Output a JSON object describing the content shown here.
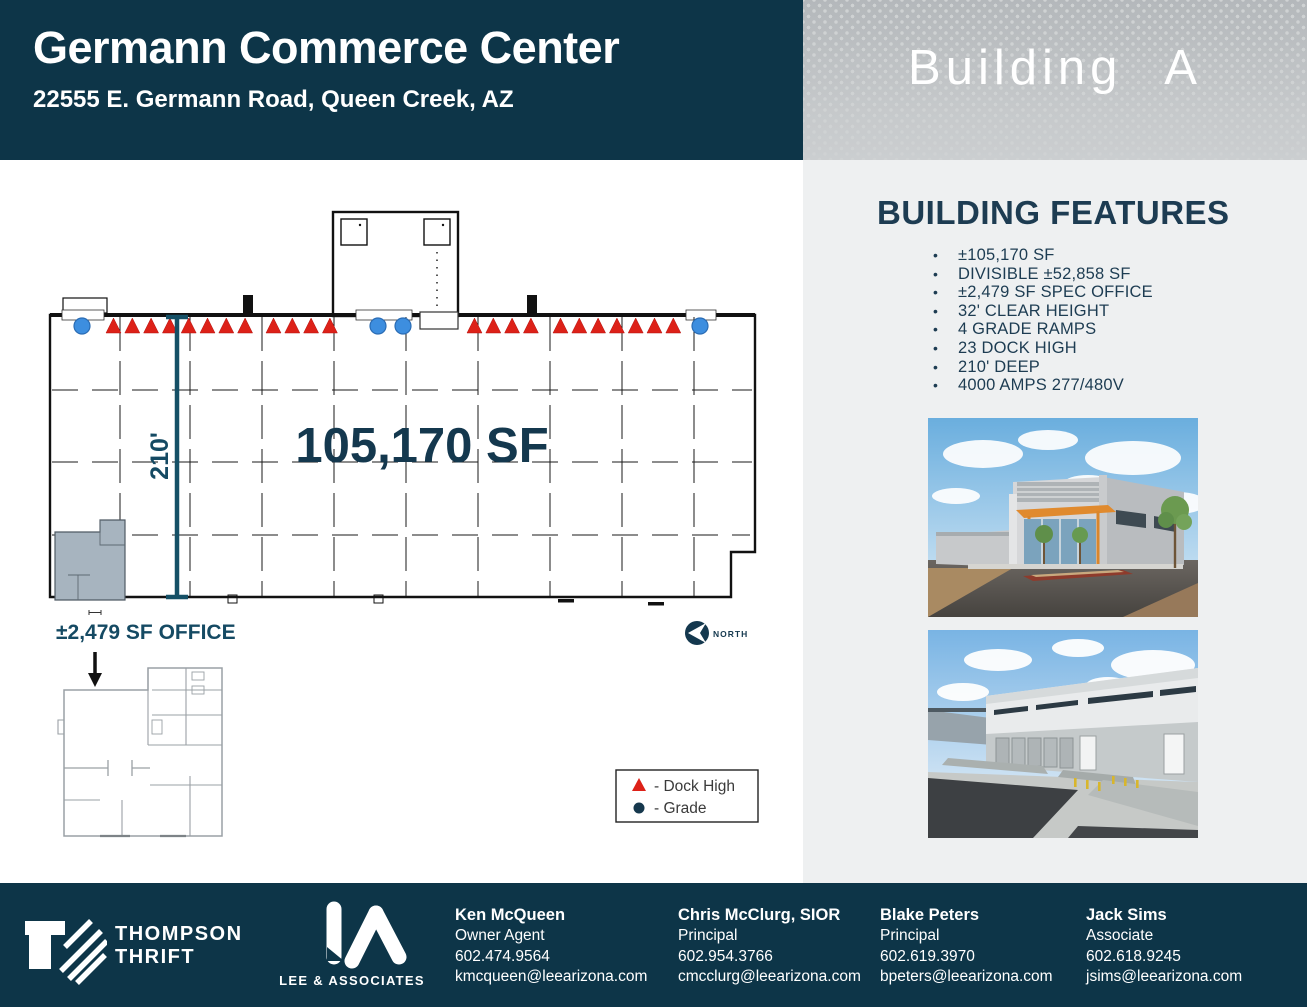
{
  "header": {
    "title": "Germann Commerce Center",
    "address": "22555 E. Germann Road, Queen Creek, AZ",
    "building_label": "Building A"
  },
  "features": {
    "title": "BUILDING FEATURES",
    "items": [
      "±105,170 SF",
      "DIVISIBLE ±52,858 SF",
      "±2,479 SF SPEC OFFICE",
      "32' CLEAR HEIGHT",
      "4 GRADE RAMPS",
      "23 DOCK HIGH",
      "210' DEEP",
      "4000 AMPS 277/480V"
    ]
  },
  "floor_plan": {
    "area_label": "105,170 SF",
    "depth_label": "210'",
    "office_label": "±2,479 SF OFFICE",
    "north_label": "NORTH",
    "legend": {
      "dock_label": "- Dock High",
      "grade_label": "- Grade"
    },
    "dock_high_count": 23,
    "grade_count": 4,
    "markers": [
      {
        "type": "grade",
        "cx": 82
      },
      {
        "type": "dock",
        "start": 106,
        "count": 8,
        "step": 18.8
      },
      {
        "type": "dock",
        "start": 266,
        "count": 4,
        "step": 18.8
      },
      {
        "type": "grade",
        "cx": 378
      },
      {
        "type": "grade",
        "cx": 403
      },
      {
        "type": "dock",
        "start": 467,
        "count": 4,
        "step": 18.8
      },
      {
        "type": "dock",
        "start": 553,
        "count": 7,
        "step": 18.8
      },
      {
        "type": "grade",
        "cx": 700
      }
    ]
  },
  "footer": {
    "brand1_line1": "THOMPSON",
    "brand1_line2": "THRIFT",
    "brand2": "LEE & ASSOCIATES",
    "contacts": [
      {
        "name": "Ken McQueen",
        "title": "Owner Agent",
        "phone": "602.474.9564",
        "email": "kmcqueen@leearizona.com"
      },
      {
        "name": "Chris McClurg, SIOR",
        "title": "Principal",
        "phone": "602.954.3766",
        "email": "cmcclurg@leearizona.com"
      },
      {
        "name": "Blake Peters",
        "title": "Principal",
        "phone": "602.619.3970",
        "email": "bpeters@leearizona.com"
      },
      {
        "name": "Jack Sims",
        "title": "Associate",
        "phone": "602.618.9245",
        "email": "jsims@leearizona.com"
      }
    ]
  },
  "colors": {
    "navy": "#0d3548",
    "features_text": "#1d3c52",
    "dock_red": "#dd2118",
    "grade_blue": "#3d8edf",
    "dimension_teal": "#154a63",
    "panel_gray": "#eef0f1"
  }
}
